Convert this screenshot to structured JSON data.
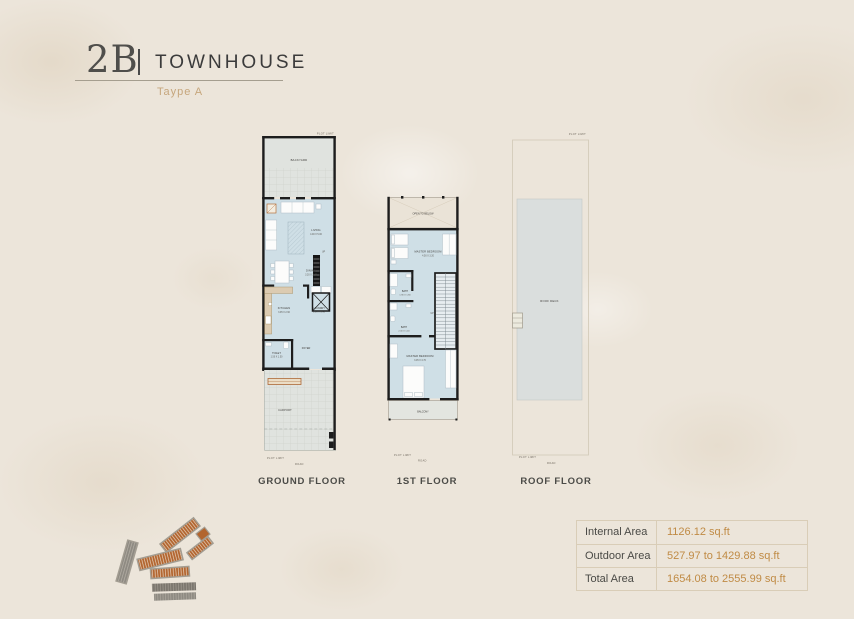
{
  "header": {
    "unit_code": "2B",
    "divider": "|",
    "title": "TOWNHOUSE",
    "subtitle": "Taype A"
  },
  "plans": {
    "common": {
      "plot_limit": "PLOT LIMIT",
      "road": "ROAD",
      "up": "UP"
    },
    "ground": {
      "label": "GROUND FLOOR",
      "rooms": {
        "backyard": "BACKYARD",
        "living": "LIVING",
        "living_dim": "4.00 X 5.00",
        "dining": "DINING",
        "dining_dim": "3.20 X 3.40",
        "kitchen": "KITCHEN",
        "kitchen_dim": "3.95 X 2.60",
        "laundry": "LAUNDRY",
        "laundry_dim": "1.00 X 1.90",
        "toilet": "TOILET",
        "toilet_dim": "1.50 X 1.50",
        "foyer": "FOYER",
        "entry": "ENTRY",
        "carport": "CARPORT"
      }
    },
    "first": {
      "label": "1ST FLOOR",
      "rooms": {
        "open_to_below": "OPEN TO BELOW",
        "master_bedroom_1": "MASTER BEDROOM",
        "master_bedroom_1_dim": "4.50 X 3.20",
        "bath_1": "BATH",
        "bath_1_dim": "1.90 X 1.80",
        "bath_2": "BATH",
        "bath_2_dim": "2.00 X 1.40",
        "master_bedroom_2": "MASTER BEDROOM",
        "master_bedroom_2_dim": "3.05 X 3.70",
        "balcony": "BALCONY"
      }
    },
    "roof": {
      "label": "ROOF FLOOR",
      "rooms": {
        "roof_deck": "ROOF DECK"
      }
    }
  },
  "area_table": {
    "rows": [
      {
        "label": "Internal Area",
        "value": "1126.12 sq.ft"
      },
      {
        "label": "Outdoor Area",
        "value": "527.97 to 1429.88 sq.ft"
      },
      {
        "label": "Total Area",
        "value": "1654.08 to 2555.99 sq.ft"
      }
    ]
  },
  "icons": {
    "masterplan_logo": "masterplan-thumbnail"
  },
  "colors": {
    "background": "#ece5da",
    "accent_gold": "#c08b45",
    "subtitle_tan": "#c6a67c",
    "plan_blue": "#cfdfe6",
    "plan_gray": "#e0e3df",
    "wall": "#1d1d1d",
    "roof_deck": "#dadedd",
    "logo_orange": "#b2652f",
    "logo_gray": "#8e8a82",
    "table_border": "#d9cdb7"
  }
}
